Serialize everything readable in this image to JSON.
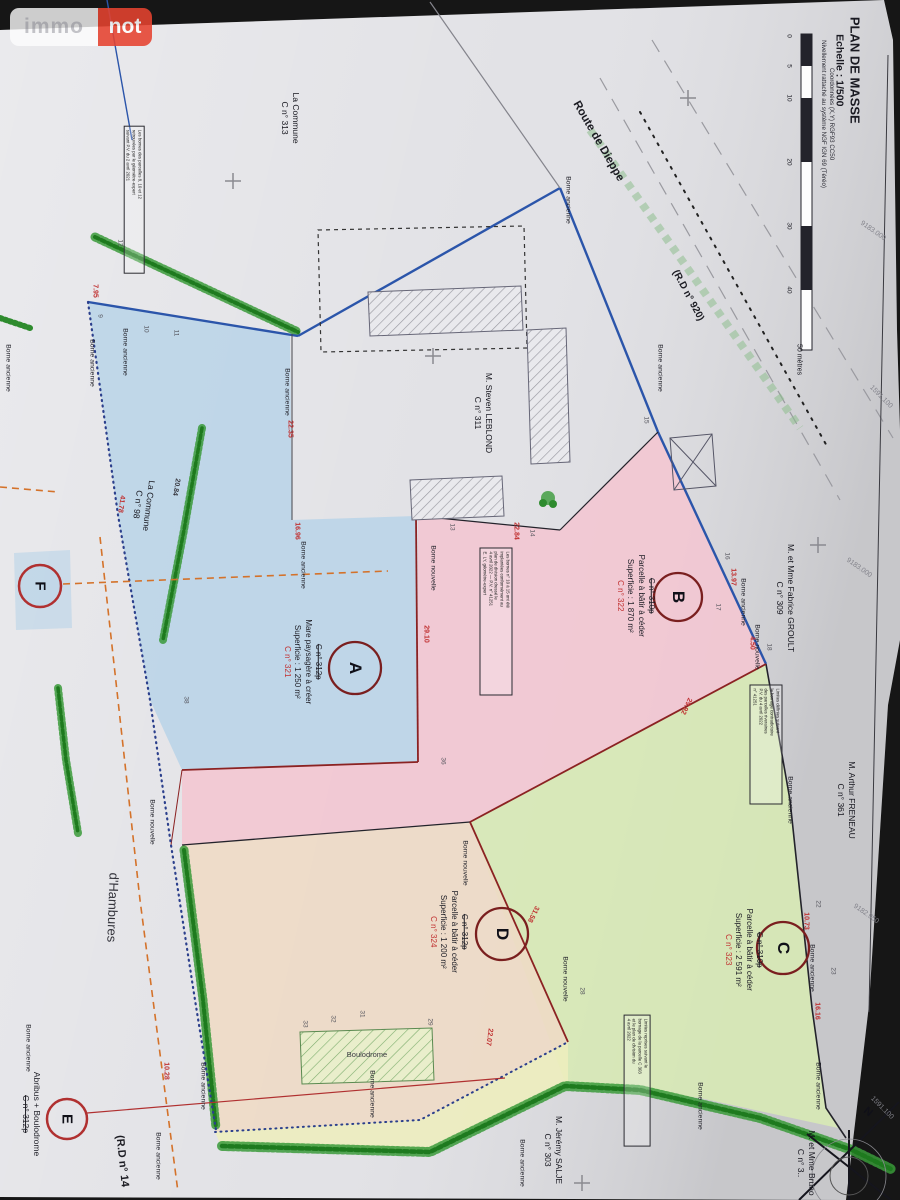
{
  "logo": {
    "left": "immo",
    "right": "not"
  },
  "title_block": {
    "line1": "PLAN DE MASSE",
    "line2": "Echelle : 1/500",
    "coord1": "Coordonnées (X,Y) RGF93 CC50",
    "coord2": "Nivellement rattaché au système NGF IGN 69 (Téréo)"
  },
  "scale_bar": {
    "ticks": [
      "0",
      "5",
      "10",
      "20",
      "30",
      "40"
    ],
    "end_label": "50 mètres"
  },
  "roads": {
    "route_dieppe": "Route de Dieppe",
    "rd920": "(R.D n° 920)",
    "rd14": "(R.D n° 14",
    "hambures": "d'Hambures"
  },
  "parcels": [
    {
      "letter": "A",
      "old": "C n° 312p",
      "desc": "Mare paysagère à créer",
      "area": "Superficie : 1 250 m²",
      "new": "C n° 321",
      "color": "#b9d3e8"
    },
    {
      "letter": "B",
      "old": "C n° 310p",
      "desc": "Parcelle à bâtir à céder",
      "area": "Superficie : 1 870 m²",
      "new": "C n° 322",
      "color": "#f3c6d2"
    },
    {
      "letter": "C",
      "old": "C n° 310p",
      "desc": "Parcelle à bâtir à céder",
      "area": "Superficie : 2 591 m²",
      "new": "C n° 323",
      "color": "#d7e9b5"
    },
    {
      "letter": "D",
      "old": "C n° 312p",
      "desc": "Parcelle à bâtir à céder",
      "area": "Superficie : 1 200 m²",
      "new": "C n° 324",
      "color": "#eedac5"
    }
  ],
  "abribus": {
    "label": "Abribus + Boulodrome",
    "old": "C n° 312p",
    "boulodrome": "Boulodrome"
  },
  "markers": {
    "E": "E",
    "F": "F",
    "north": "N"
  },
  "owners": [
    {
      "name": "M. Steven LEBLOND",
      "num": "C n° 311"
    },
    {
      "name": "M. et Mme Fabrice GROULT",
      "num": "C n° 309"
    },
    {
      "name": "M. Arthur FRENEAU",
      "num": "C n° 361"
    },
    {
      "name": "M. Jérémy SALJE",
      "num": "C n° 303"
    },
    {
      "name": "M. et Mme Bruno",
      "num": "C n° 3.."
    },
    {
      "name": "La Commune",
      "num": "C n° 313"
    },
    {
      "name": "La Commune",
      "num": "C n° 98"
    }
  ],
  "grid_labels": [
    {
      "t": "9183.000",
      "x": 873,
      "y": 231,
      "r": 35
    },
    {
      "t": "9183.000",
      "x": 859,
      "y": 568,
      "r": 35
    },
    {
      "t": "9182.950",
      "x": 866,
      "y": 914,
      "r": 35
    },
    {
      "t": "1591.100",
      "x": 881,
      "y": 397,
      "r": 45
    },
    {
      "t": "1591.100",
      "x": 882,
      "y": 1108,
      "r": 45
    }
  ],
  "borne_labels": [
    {
      "t": "Borne ancienne",
      "x": 8,
      "y": 368
    },
    {
      "t": "Borne ancienne",
      "x": 92,
      "y": 363
    },
    {
      "t": "Borne ancienne",
      "x": 125,
      "y": 352
    },
    {
      "t": "Borne ancienne",
      "x": 287,
      "y": 392
    },
    {
      "t": "Borne ancienne",
      "x": 303,
      "y": 565
    },
    {
      "t": "Borne ancienne",
      "x": 568,
      "y": 200
    },
    {
      "t": "Borne ancienne",
      "x": 660,
      "y": 368
    },
    {
      "t": "Borne ancienne",
      "x": 743,
      "y": 602
    },
    {
      "t": "Borne ancienne",
      "x": 790,
      "y": 800
    },
    {
      "t": "Borne ancienne",
      "x": 812,
      "y": 968
    },
    {
      "t": "Borne ancienne",
      "x": 818,
      "y": 1086
    },
    {
      "t": "Borne ancienne",
      "x": 203,
      "y": 1086
    },
    {
      "t": "Borne ancienne",
      "x": 158,
      "y": 1156
    },
    {
      "t": "Borne ancienne",
      "x": 372,
      "y": 1094
    },
    {
      "t": "Borne ancienne",
      "x": 522,
      "y": 1163
    },
    {
      "t": "Borne ancienne",
      "x": 700,
      "y": 1106
    },
    {
      "t": "Borne ancienne",
      "x": 28,
      "y": 1048
    },
    {
      "t": "Borne nouvelle",
      "x": 433,
      "y": 568
    },
    {
      "t": "Borne nouvelle",
      "x": 757,
      "y": 647
    },
    {
      "t": "Borne nouvelle",
      "x": 465,
      "y": 863
    },
    {
      "t": "Borne nouvelle",
      "x": 565,
      "y": 979
    },
    {
      "t": "Borne nouvelle",
      "x": 152,
      "y": 822
    }
  ],
  "point_numbers": [
    {
      "t": "9",
      "x": 100,
      "y": 316
    },
    {
      "t": "10",
      "x": 146,
      "y": 329
    },
    {
      "t": "11",
      "x": 176,
      "y": 333
    },
    {
      "t": "12",
      "x": 120,
      "y": 243
    },
    {
      "t": "13",
      "x": 452,
      "y": 527
    },
    {
      "t": "14",
      "x": 532,
      "y": 533
    },
    {
      "t": "15",
      "x": 646,
      "y": 420
    },
    {
      "t": "16",
      "x": 727,
      "y": 556
    },
    {
      "t": "17",
      "x": 718,
      "y": 607
    },
    {
      "t": "18",
      "x": 769,
      "y": 647
    },
    {
      "t": "22",
      "x": 818,
      "y": 904
    },
    {
      "t": "23",
      "x": 833,
      "y": 971
    },
    {
      "t": "28",
      "x": 582,
      "y": 991
    },
    {
      "t": "29",
      "x": 430,
      "y": 1022
    },
    {
      "t": "31",
      "x": 362,
      "y": 1014
    },
    {
      "t": "32",
      "x": 333,
      "y": 1019
    },
    {
      "t": "33",
      "x": 305,
      "y": 1024
    },
    {
      "t": "36",
      "x": 443,
      "y": 761
    },
    {
      "t": "38",
      "x": 186,
      "y": 700
    }
  ],
  "measurements": [
    {
      "t": "7.95",
      "x": 95,
      "y": 291
    },
    {
      "t": "22.35",
      "x": 290,
      "y": 429
    },
    {
      "t": "16.96",
      "x": 297,
      "y": 531
    },
    {
      "t": "29.10",
      "x": 426,
      "y": 634
    },
    {
      "t": "22.84",
      "x": 516,
      "y": 531
    },
    {
      "t": "13.97",
      "x": 733,
      "y": 577
    },
    {
      "t": "4.50",
      "x": 752,
      "y": 643
    },
    {
      "t": "29.92",
      "x": 686,
      "y": 706,
      "r": 115
    },
    {
      "t": "10.73",
      "x": 806,
      "y": 921
    },
    {
      "t": "16.16",
      "x": 817,
      "y": 1011
    },
    {
      "t": "31.58",
      "x": 533,
      "y": 914,
      "r": 117
    },
    {
      "t": "22.07",
      "x": 489,
      "y": 1037,
      "r": 98
    },
    {
      "t": "41.78",
      "x": 121,
      "y": 504,
      "r": 98
    },
    {
      "t": "10.28",
      "x": 166,
      "y": 1071
    },
    {
      "t": "20.84",
      "x": 176,
      "y": 487,
      "r": 100,
      "c": "#3a3a42"
    }
  ],
  "notes": [
    {
      "lines": [
        "Les bornes des parcelles 8, 10 et 12",
        "retrouvées par le géomètre-expert",
        "suivant P.V. du 2 avril 2021"
      ]
    },
    {
      "lines": [
        "Les bornes n° 10 à 15 ont été",
        "implantées conformément au",
        "plan de division dressé le",
        "4 avril 2022 — P.V. n° 41251",
        "E. LY, géomètre-expert"
      ]
    },
    {
      "lines": [
        "Limites définies suivant",
        "le bornage contradictoire",
        "des parcelles riveraines",
        "P.V. du 4 avril 2022",
        "n° 41251"
      ]
    },
    {
      "lines": [
        "Limites reprises suivant le",
        "bornage de la parcelle C 303",
        "et le plan de division du",
        "4 avril 2022"
      ]
    }
  ],
  "colors": {
    "paper": "#e2e2e6",
    "perimeter_blue": "#2b55aa",
    "hedge_green": "#2e8b2e",
    "division_red": "#8b2222",
    "measure_red": "#c03030",
    "orange_dash": "#d4722a",
    "logo_red": "#e64330",
    "parcel_ring": "#7a1f1f"
  }
}
